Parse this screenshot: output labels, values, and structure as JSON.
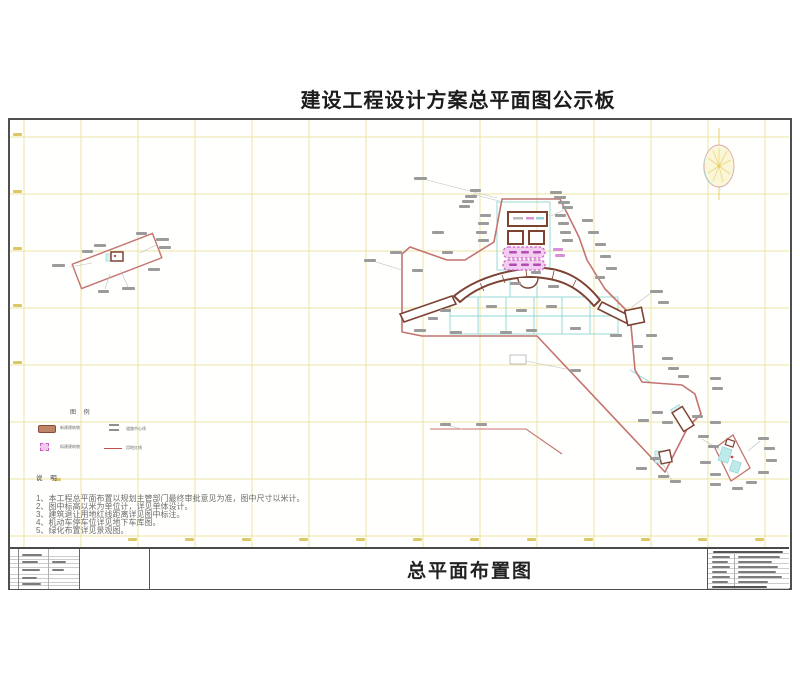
{
  "page": {
    "board_title": "建设工程设计方案总平面图公示板",
    "drawing_title": "总平面布置图"
  },
  "legend": {
    "header": "图 例",
    "items": [
      {
        "label": "新建建筑物",
        "swatch": "brown-building-swatch"
      },
      {
        "label": "道路中心线",
        "swatch": "double-line-symbol"
      },
      {
        "label": "拟建建筑物",
        "swatch": "pink-dashed-swatch"
      },
      {
        "label": "用地红线",
        "swatch": "red-line-swatch"
      }
    ]
  },
  "notes": {
    "header": "说 明",
    "lines": [
      "1、本工程总平面布置以规划主管部门最终审批意见为准，图中尺寸以米计。",
      "2、图中标高以米为单位计，详见单体设计。",
      "3、建筑退让用地红线距离详见图中标注。",
      "4、机动车停车位详见地下车库图。",
      "5、绿化布置详见景观图。"
    ]
  },
  "colors": {
    "boundary_red_line": "#c4736f",
    "building_outline": "#7e4233",
    "proposed_building_fill": "#f3cdef",
    "road_line_cyan": "#8fd6d6",
    "survey_grid_yellow": "#eee3a4"
  }
}
